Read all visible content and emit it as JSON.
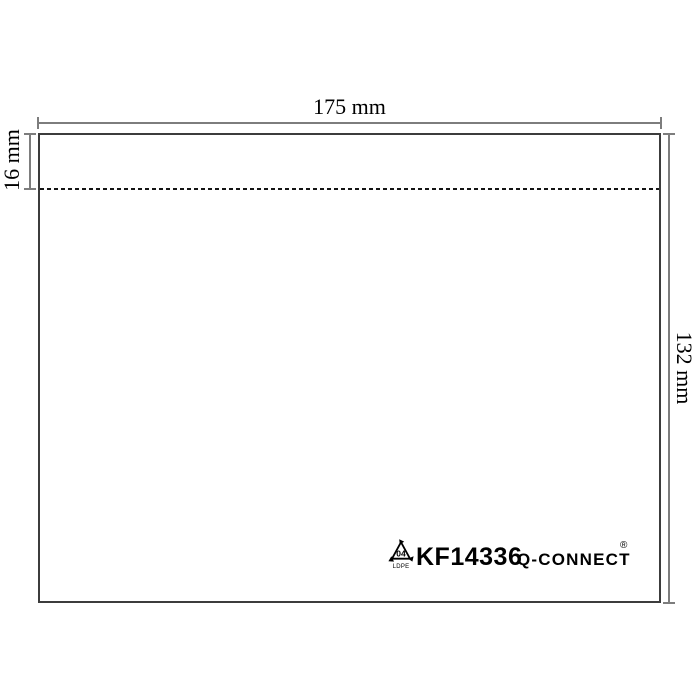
{
  "diagram": {
    "subject": "envelope-wallet-dimension-drawing",
    "dimensions": {
      "width_label": "175 mm",
      "flap_label": "16 mm",
      "height_label": "132 mm"
    },
    "logo": {
      "resin_code": "04",
      "resin_material": "LDPE",
      "product_code": "KF14336",
      "brand": "Q-CONNECT",
      "registered_mark": "®"
    },
    "colors": {
      "outline": "#3c3c3c",
      "dimension_lines": "#7d7d7d",
      "dashed_line": "#141414",
      "text": "#000000",
      "background": "#ffffff"
    }
  }
}
